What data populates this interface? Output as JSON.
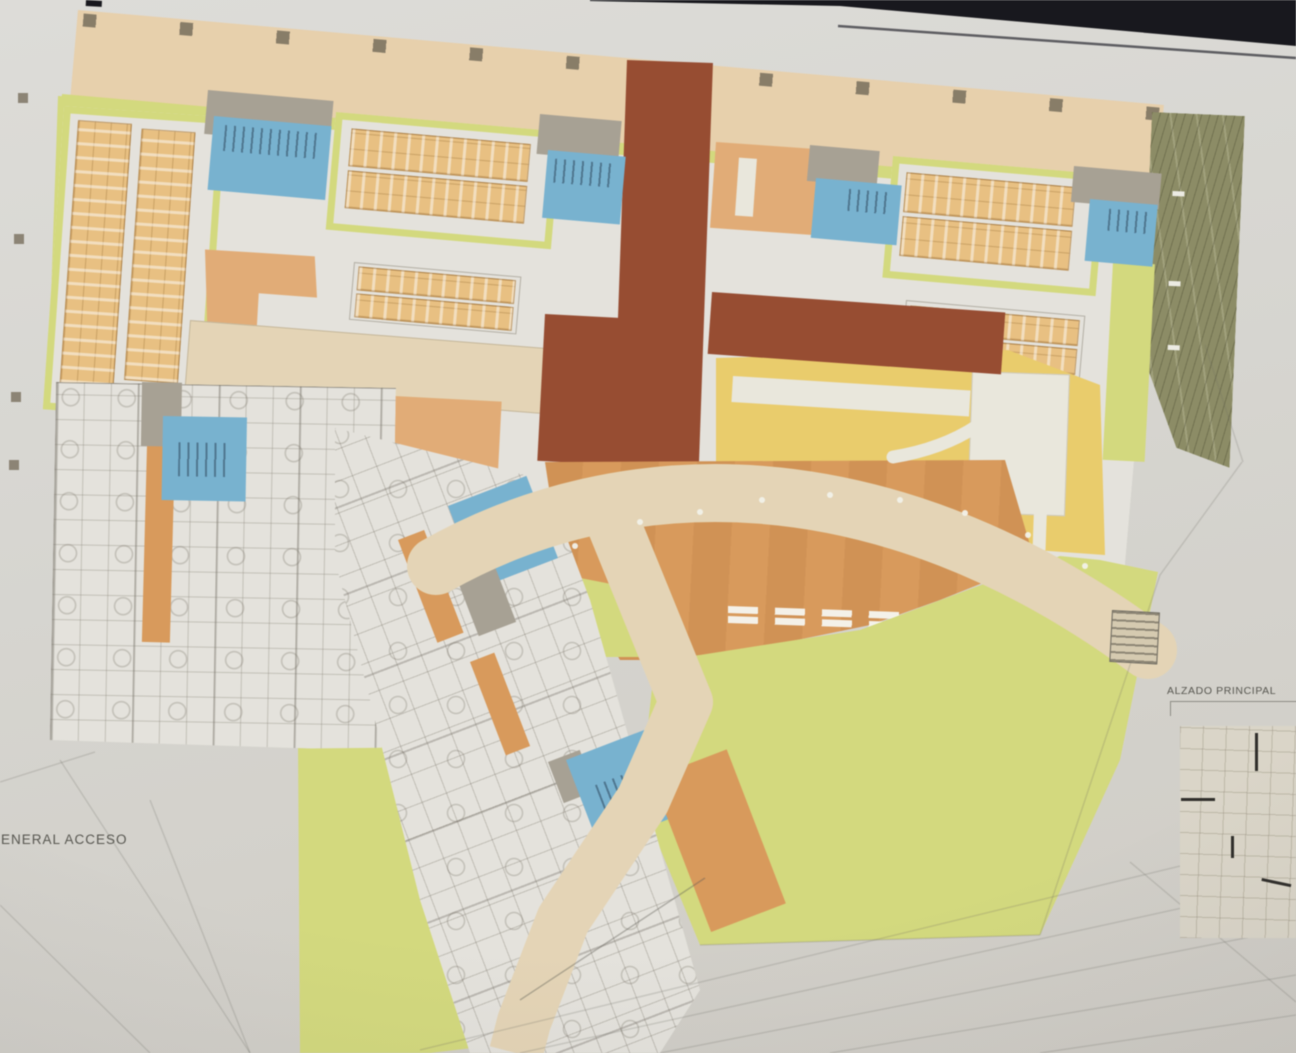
{
  "labels": {
    "access_label": "ENERAL ACCESO",
    "elevation_label": "ALZADO PRINCIPAL"
  },
  "colors": {
    "board": "#d6d5d0",
    "frame": "#15151b",
    "paper": "#e7e5de",
    "cream": "#ecd2aa",
    "lime": "#d6dc77",
    "blue": "#74b4d5",
    "core-gray": "#a9a294",
    "orange": "#df9a55",
    "orange-light": "#e8ad72",
    "brick": "#9c4a2d",
    "tan": "#eec27d",
    "yellow": "#efce64",
    "olive": "#8d8d62",
    "beige": "#e8d7b5",
    "wall": "#8a8578",
    "ink": "#56554e"
  }
}
